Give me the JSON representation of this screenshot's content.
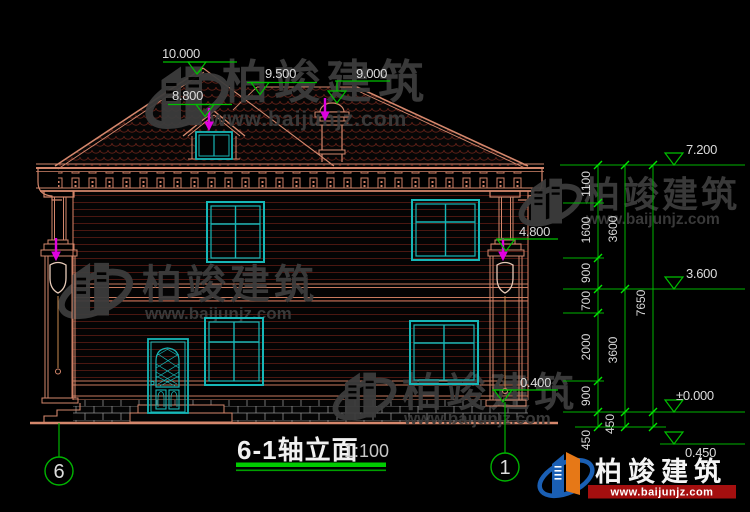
{
  "drawing": {
    "title": {
      "text": "6-1轴立面",
      "scale": "1:100"
    },
    "levels": {
      "peak": "10.000",
      "dormer": "8.800",
      "ridge": "9.500",
      "chimney": "9.000",
      "eave": "7.200",
      "capital": "4.800",
      "floor2": "3.600",
      "zero": "±0.000",
      "porch": "0.400",
      "grade": "0.450"
    },
    "dims": {
      "col1": [
        "1100",
        "1600",
        "900",
        "700",
        "2000",
        "900",
        "450"
      ],
      "col2": [
        "3600",
        "3600",
        "450"
      ],
      "col3": [
        "7650"
      ]
    },
    "axes": {
      "left": "6",
      "right": "1"
    },
    "brand": {
      "name": "柏竣建筑",
      "url": "www.baijunjz.com"
    },
    "colors": {
      "building_line": "#d4876c",
      "glass": "#17b7b7",
      "dim_green": "#00c000",
      "tick_green": "#00ff00",
      "magenta": "#e000e0",
      "roof_tile": "#5a1e16",
      "brick_mortar": "#8f8f8f",
      "watermark_gray": "#3d3d3d",
      "logo_blue": "#1a5fb4",
      "logo_orange": "#e67817",
      "banner_red": "#a50f0f"
    }
  }
}
